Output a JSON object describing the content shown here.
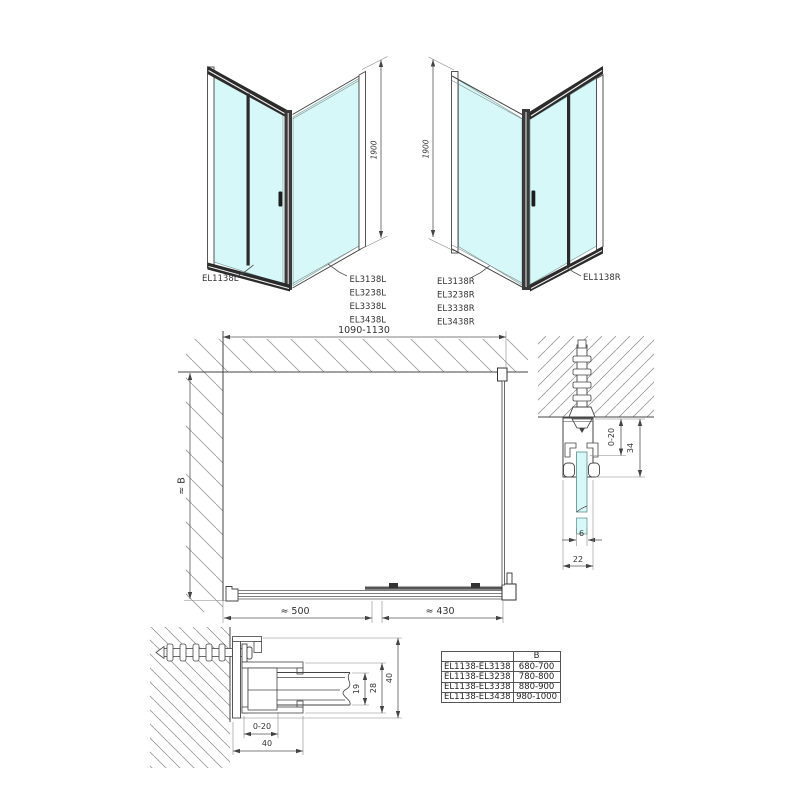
{
  "colors": {
    "glass": "#d6f8f8",
    "outline": "#444444",
    "dark_frame": "#2b2b2b",
    "dimension": "#555555",
    "hatch": "#999999",
    "text": "#333333",
    "background": "#ffffff"
  },
  "left_view": {
    "door_label": "EL1138L",
    "panel_labels": [
      "EL3138L",
      "EL3238L",
      "EL3338L",
      "EL3438L"
    ],
    "height_dim": "1900"
  },
  "right_view": {
    "door_label": "EL1138R",
    "panel_labels": [
      "EL3138R",
      "EL3238R",
      "EL3338R",
      "EL3438R"
    ],
    "height_dim": "1900"
  },
  "plan_view": {
    "width_dim": "1090-1130",
    "depth_dim": "≈ B",
    "opening_dim": "≈ 500",
    "fixed_dim": "≈ 430"
  },
  "wall_profile_detail": {
    "adjust_dim": "0-20",
    "height_dim": "34",
    "glass_dim": "6",
    "depth_dim": "22"
  },
  "floor_profile_detail": {
    "pocket_dim": "19",
    "channel_dim": "28",
    "profile_dim": "40",
    "adjust_dim": "0-20",
    "width_dim": "40"
  },
  "size_table": {
    "headers": [
      "",
      "B"
    ],
    "rows": [
      [
        "EL1138-EL3138",
        "680-700"
      ],
      [
        "EL1138-EL3238",
        "780-800"
      ],
      [
        "EL1138-EL3338",
        "880-900"
      ],
      [
        "EL1138-EL3438",
        "980-1000"
      ]
    ]
  }
}
